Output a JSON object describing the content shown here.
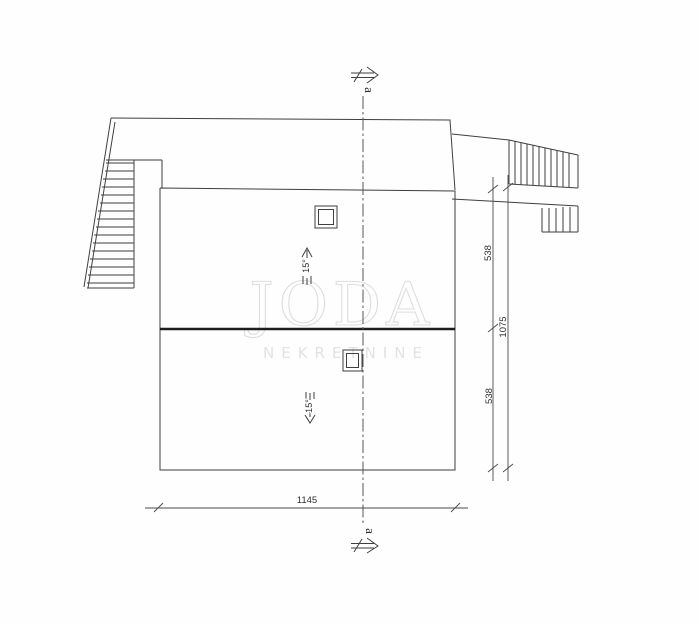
{
  "labels": {
    "section_top": "a",
    "section_bottom": "a",
    "slope_upper": "15°",
    "slope_lower": "15°"
  },
  "dimensions": {
    "right_upper": "538",
    "right_total": "1075",
    "right_lower": "538",
    "bottom_width": "1145"
  },
  "watermark": {
    "title": "JODA",
    "subtitle": "NEKRETNINE"
  },
  "colors": {
    "line": "#3f3f3f",
    "ridge": "#1e1e1e",
    "dimension_line": "#4a4a4a",
    "watermark": "#dedede",
    "background": "#fefefe"
  },
  "icons": {
    "section_cut_arrow": "⇒",
    "slope_up_arrow": "↑",
    "slope_down_arrow": "↓"
  }
}
